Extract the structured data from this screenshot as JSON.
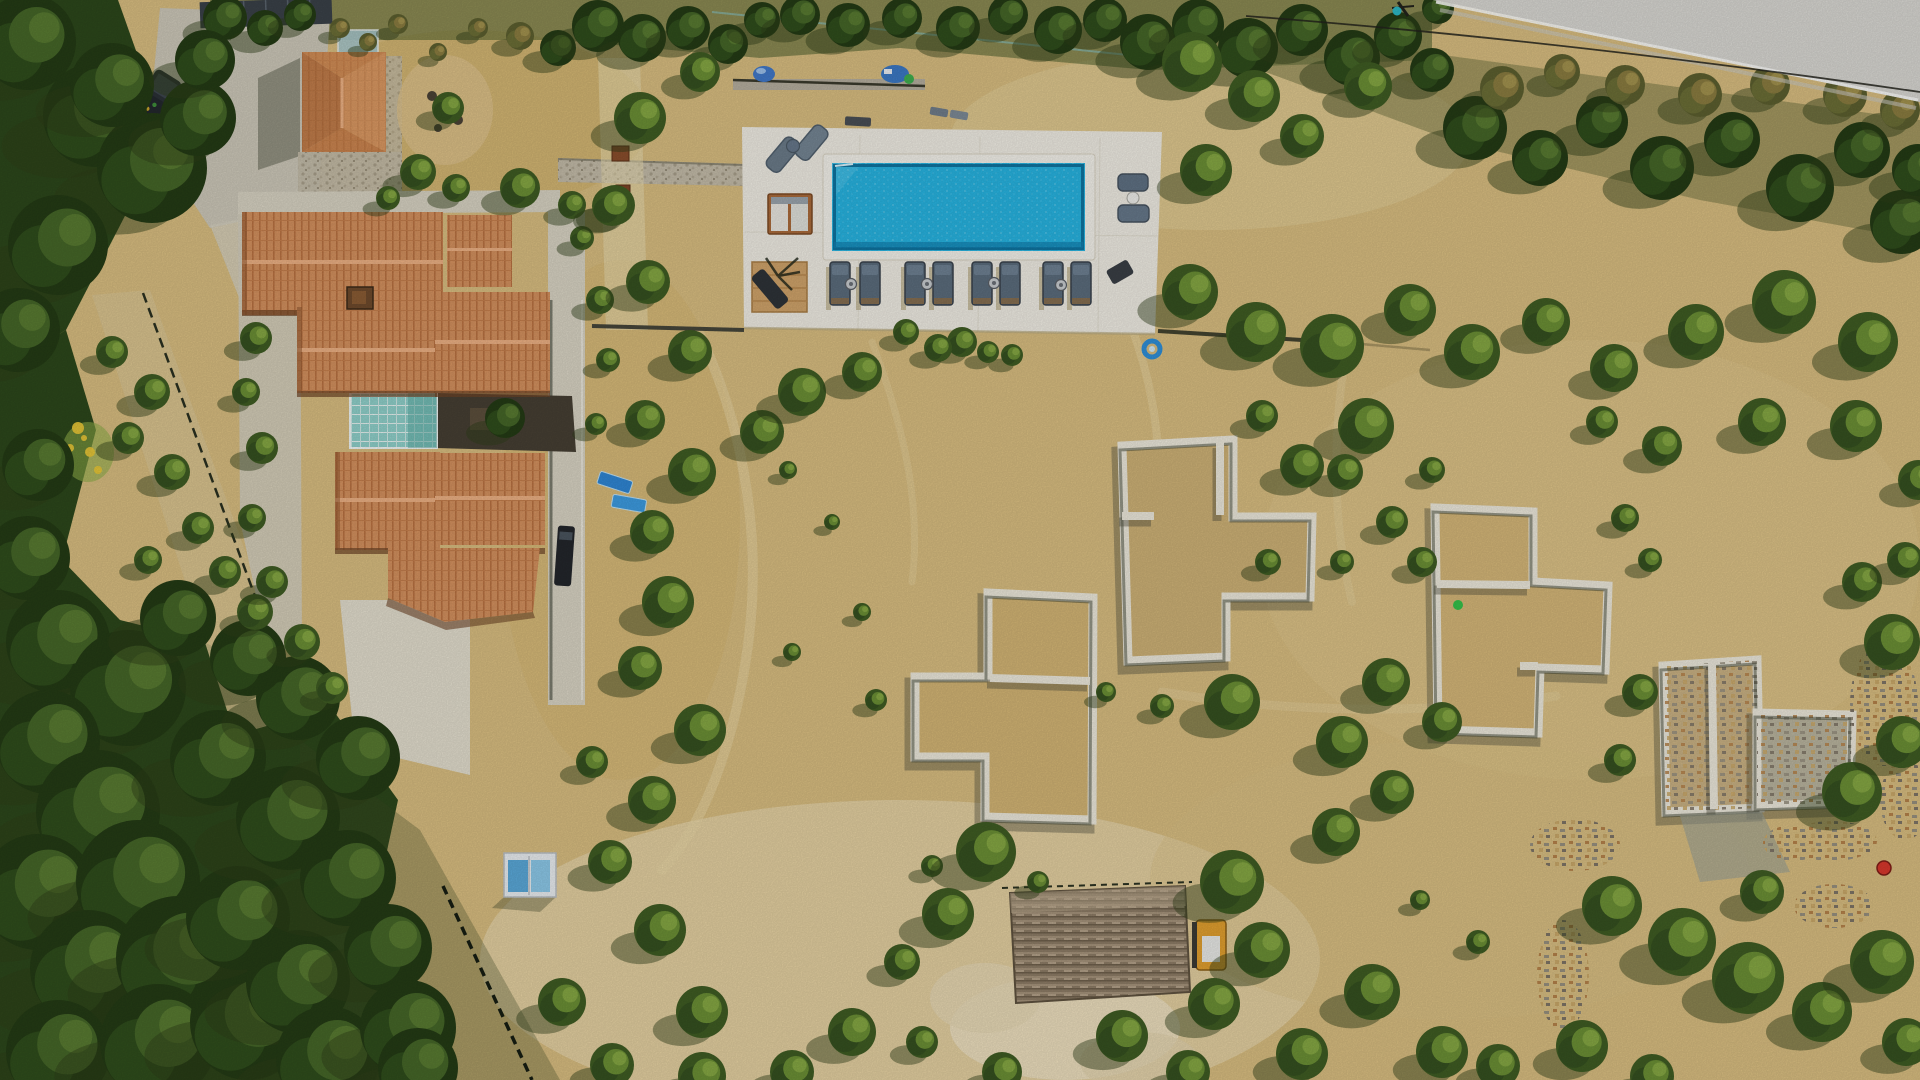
{
  "meta": {
    "type": "aerial-drone-photograph",
    "subject": "Mediterranean villa estate with swimming pool, olive grove and construction foundations",
    "width": 1920,
    "height": 1080,
    "sun_direction": "upper-right",
    "no_visible_text": true
  },
  "palette": {
    "sand": "#d8bd80",
    "sand_light": "#ecdfba",
    "sand_dark": "#c6a55e",
    "forest": "#2c471b",
    "road": "#d8d7d2",
    "driveway": "#ccc7b8",
    "deck": "#efece3",
    "pool_water": "#27b3e0",
    "pool_edge": "#0f74a0",
    "roof_tile": "#d3905e",
    "roof_shadow": "#6e4526",
    "foundation_wall": "#ece8db",
    "lounger": "#5b6c7c",
    "wood_deck": "#8d7c66",
    "atrium_glass": "#8fd0ca"
  },
  "scene": {
    "counts": {
      "sun_loungers_row": 8,
      "side_tables": 4,
      "foundations": 5,
      "cars": 2,
      "villa_roofs": 7
    },
    "pool": {
      "x": 832,
      "y": 163,
      "w": 253,
      "h": 88,
      "lounger_row": {
        "y": 262,
        "w": 20,
        "h": 43,
        "xs": [
          830,
          860,
          905,
          933,
          972,
          1000,
          1043,
          1071
        ],
        "tables": [
          [
            851,
            284
          ],
          [
            927,
            284
          ],
          [
            994,
            283
          ],
          [
            1061,
            285
          ]
        ]
      }
    },
    "foundations": [
      {
        "outline": [
          [
            1122,
            446
          ],
          [
            1233,
            440
          ],
          [
            1233,
            517
          ],
          [
            1312,
            517
          ],
          [
            1310,
            597
          ],
          [
            1226,
            597
          ],
          [
            1226,
            657
          ],
          [
            1128,
            661
          ]
        ],
        "walls": [
          [
            [
              1122,
              516
            ],
            [
              1154,
              516
            ]
          ],
          [
            [
              1220,
              442
            ],
            [
              1220,
              515
            ]
          ]
        ],
        "fill": "#cdb176",
        "rubble": false
      },
      {
        "outline": [
          [
            988,
            593
          ],
          [
            1093,
            598
          ],
          [
            1092,
            820
          ],
          [
            985,
            817
          ],
          [
            985,
            757
          ],
          [
            915,
            757
          ],
          [
            915,
            677
          ],
          [
            988,
            677
          ]
        ],
        "walls": [
          [
            [
              990,
              678
            ],
            [
              1090,
              681
            ]
          ]
        ],
        "fill": "#d2b474",
        "rubble": false
      },
      {
        "outline": [
          [
            1435,
            508
          ],
          [
            1533,
            512
          ],
          [
            1533,
            582
          ],
          [
            1608,
            586
          ],
          [
            1605,
            670
          ],
          [
            1540,
            668
          ],
          [
            1538,
            733
          ],
          [
            1438,
            730
          ]
        ],
        "walls": [
          [
            [
              1437,
              584
            ],
            [
              1530,
              585
            ]
          ],
          [
            [
              1520,
              666
            ],
            [
              1538,
              666
            ]
          ]
        ],
        "fill": "#d4b678",
        "rubble": false
      },
      {
        "outline": [
          [
            1663,
            666
          ],
          [
            1757,
            660
          ],
          [
            1760,
            808
          ],
          [
            1666,
            812
          ]
        ],
        "walls": [
          [
            [
              1712,
              663
            ],
            [
              1714,
              809
            ]
          ]
        ],
        "fill": "#c9b183",
        "rubble": true
      },
      {
        "outline": [
          [
            1757,
            713
          ],
          [
            1852,
            715
          ],
          [
            1850,
            803
          ],
          [
            1757,
            806
          ]
        ],
        "walls": [],
        "fill": "#b9b49e",
        "rubble": true
      }
    ],
    "trees": [
      [
        225,
        18,
        22,
        1
      ],
      [
        265,
        28,
        18,
        1
      ],
      [
        300,
        15,
        16,
        1
      ],
      [
        340,
        28,
        10,
        2
      ],
      [
        368,
        42,
        9,
        2
      ],
      [
        398,
        24,
        10,
        2
      ],
      [
        438,
        52,
        9,
        2
      ],
      [
        478,
        28,
        10,
        2
      ],
      [
        520,
        36,
        14,
        2
      ],
      [
        558,
        48,
        18,
        1
      ],
      [
        598,
        26,
        26,
        1
      ],
      [
        642,
        38,
        24,
        1
      ],
      [
        688,
        28,
        22,
        1
      ],
      [
        728,
        44,
        20,
        1
      ],
      [
        762,
        20,
        18,
        1
      ],
      [
        800,
        15,
        20,
        1
      ],
      [
        848,
        25,
        22,
        1
      ],
      [
        902,
        18,
        20,
        1
      ],
      [
        958,
        28,
        22,
        1
      ],
      [
        1008,
        15,
        20,
        1
      ],
      [
        1058,
        30,
        24,
        1
      ],
      [
        1105,
        20,
        22,
        1
      ],
      [
        1148,
        42,
        28,
        1
      ],
      [
        1198,
        25,
        26,
        1
      ],
      [
        1248,
        48,
        30,
        1
      ],
      [
        1302,
        30,
        26,
        1
      ],
      [
        1352,
        58,
        28,
        1
      ],
      [
        1398,
        36,
        24,
        1
      ],
      [
        1432,
        70,
        22,
        1
      ],
      [
        1438,
        8,
        16,
        1
      ],
      [
        1475,
        128,
        32,
        1
      ],
      [
        1540,
        158,
        28,
        1
      ],
      [
        1602,
        122,
        26,
        1
      ],
      [
        1662,
        168,
        32,
        1
      ],
      [
        1732,
        140,
        28,
        1
      ],
      [
        1800,
        188,
        34,
        1
      ],
      [
        1862,
        150,
        28,
        1
      ],
      [
        1902,
        222,
        32,
        1
      ],
      [
        1502,
        88,
        22,
        2
      ],
      [
        1562,
        72,
        18,
        2
      ],
      [
        1625,
        85,
        20,
        2
      ],
      [
        1700,
        95,
        22,
        2
      ],
      [
        1770,
        85,
        20,
        2
      ],
      [
        1845,
        95,
        22,
        2
      ],
      [
        1900,
        110,
        20,
        2
      ],
      [
        1918,
        170,
        26,
        1
      ],
      [
        28,
        42,
        48,
        1
      ],
      [
        95,
        115,
        52,
        1
      ],
      [
        152,
        168,
        55,
        1
      ],
      [
        58,
        245,
        50,
        1
      ],
      [
        18,
        330,
        42,
        1
      ],
      [
        112,
        85,
        42,
        1
      ],
      [
        198,
        118,
        38,
        1
      ],
      [
        205,
        60,
        30,
        1
      ],
      [
        38,
        465,
        36,
        1
      ],
      [
        28,
        558,
        42,
        1
      ],
      [
        58,
        642,
        52,
        1
      ],
      [
        128,
        688,
        58,
        1
      ],
      [
        48,
        742,
        52,
        1
      ],
      [
        98,
        812,
        62,
        1
      ],
      [
        38,
        892,
        58,
        1
      ],
      [
        138,
        882,
        62,
        1
      ],
      [
        88,
        968,
        58,
        1
      ],
      [
        178,
        958,
        62,
        1
      ],
      [
        58,
        1052,
        52,
        1
      ],
      [
        158,
        1042,
        58,
        1
      ],
      [
        248,
        1022,
        58,
        1
      ],
      [
        238,
        918,
        52,
        1
      ],
      [
        298,
        982,
        52,
        1
      ],
      [
        328,
        1058,
        52,
        1
      ],
      [
        218,
        758,
        48,
        1
      ],
      [
        288,
        818,
        52,
        1
      ],
      [
        348,
        878,
        48,
        1
      ],
      [
        388,
        948,
        44,
        1
      ],
      [
        408,
        1028,
        48,
        1
      ],
      [
        298,
        698,
        42,
        1
      ],
      [
        358,
        758,
        42,
        1
      ],
      [
        248,
        658,
        38,
        1
      ],
      [
        178,
        618,
        38,
        1
      ],
      [
        418,
        1068,
        40,
        1
      ],
      [
        112,
        352,
        16,
        0
      ],
      [
        152,
        392,
        18,
        0
      ],
      [
        128,
        438,
        16,
        0
      ],
      [
        172,
        472,
        18,
        0
      ],
      [
        198,
        528,
        16,
        0
      ],
      [
        148,
        560,
        14,
        0
      ],
      [
        225,
        572,
        16,
        0
      ],
      [
        255,
        612,
        18,
        0
      ],
      [
        256,
        338,
        16,
        0
      ],
      [
        246,
        392,
        14,
        0
      ],
      [
        262,
        448,
        16,
        0
      ],
      [
        252,
        518,
        14,
        0
      ],
      [
        272,
        582,
        16,
        0
      ],
      [
        302,
        642,
        18,
        0
      ],
      [
        332,
        688,
        16,
        0
      ],
      [
        600,
        300,
        14,
        0
      ],
      [
        608,
        360,
        12,
        0
      ],
      [
        596,
        424,
        11,
        0
      ],
      [
        582,
        238,
        12,
        0
      ],
      [
        615,
        205,
        20,
        0
      ],
      [
        572,
        205,
        14,
        0
      ],
      [
        505,
        418,
        20,
        1
      ],
      [
        418,
        172,
        18,
        0
      ],
      [
        456,
        188,
        14,
        0
      ],
      [
        520,
        188,
        20,
        0
      ],
      [
        448,
        108,
        16,
        0
      ],
      [
        388,
        198,
        12,
        0
      ],
      [
        640,
        118,
        26,
        0
      ],
      [
        700,
        72,
        20,
        0
      ],
      [
        612,
        206,
        20,
        0
      ],
      [
        648,
        282,
        22,
        0
      ],
      [
        690,
        352,
        22,
        0
      ],
      [
        645,
        420,
        20,
        0
      ],
      [
        692,
        472,
        24,
        0
      ],
      [
        652,
        532,
        22,
        0
      ],
      [
        668,
        602,
        26,
        0
      ],
      [
        640,
        668,
        22,
        0
      ],
      [
        700,
        730,
        26,
        0
      ],
      [
        652,
        800,
        24,
        0
      ],
      [
        610,
        862,
        22,
        0
      ],
      [
        660,
        930,
        26,
        0
      ],
      [
        702,
        1012,
        26,
        0
      ],
      [
        612,
        1065,
        22,
        0
      ],
      [
        562,
        1002,
        24,
        0
      ],
      [
        592,
        762,
        16,
        0
      ],
      [
        762,
        432,
        22,
        0
      ],
      [
        802,
        392,
        24,
        0
      ],
      [
        862,
        372,
        20,
        0
      ],
      [
        906,
        332,
        13,
        0
      ],
      [
        788,
        470,
        9,
        0
      ],
      [
        832,
        522,
        8,
        0
      ],
      [
        862,
        612,
        9,
        0
      ],
      [
        962,
        342,
        15,
        0
      ],
      [
        1012,
        355,
        11,
        0
      ],
      [
        876,
        700,
        11,
        0
      ],
      [
        792,
        652,
        9,
        0
      ],
      [
        938,
        348,
        14,
        0
      ],
      [
        988,
        352,
        11,
        0
      ],
      [
        932,
        866,
        11,
        0
      ],
      [
        986,
        852,
        30,
        0
      ],
      [
        948,
        914,
        26,
        0
      ],
      [
        1038,
        882,
        11,
        0
      ],
      [
        902,
        962,
        18,
        0
      ],
      [
        852,
        1032,
        24,
        0
      ],
      [
        792,
        1072,
        22,
        0
      ],
      [
        702,
        1076,
        24,
        0
      ],
      [
        922,
        1042,
        16,
        0
      ],
      [
        1002,
        1072,
        20,
        0
      ],
      [
        1122,
        1036,
        26,
        0
      ],
      [
        1188,
        1072,
        22,
        0
      ],
      [
        1232,
        882,
        32,
        0
      ],
      [
        1262,
        950,
        28,
        0
      ],
      [
        1214,
        1004,
        26,
        0
      ],
      [
        1302,
        1054,
        26,
        0
      ],
      [
        1372,
        992,
        28,
        0
      ],
      [
        1442,
        1052,
        26,
        0
      ],
      [
        1498,
        1066,
        22,
        0
      ],
      [
        1582,
        1046,
        26,
        0
      ],
      [
        1652,
        1076,
        22,
        0
      ],
      [
        1612,
        906,
        30,
        0
      ],
      [
        1682,
        942,
        34,
        0
      ],
      [
        1748,
        978,
        36,
        0
      ],
      [
        1822,
        1012,
        30,
        0
      ],
      [
        1882,
        962,
        32,
        0
      ],
      [
        1906,
        1042,
        24,
        0
      ],
      [
        1762,
        892,
        22,
        0
      ],
      [
        1852,
        792,
        30,
        0
      ],
      [
        1902,
        742,
        26,
        0
      ],
      [
        1892,
        642,
        28,
        0
      ],
      [
        1862,
        582,
        20,
        0
      ],
      [
        1478,
        942,
        12,
        0
      ],
      [
        1420,
        900,
        10,
        0
      ],
      [
        1192,
        62,
        30,
        0
      ],
      [
        1254,
        96,
        26,
        0
      ],
      [
        1206,
        170,
        26,
        0
      ],
      [
        1302,
        136,
        22,
        0
      ],
      [
        1368,
        86,
        24,
        0
      ],
      [
        1190,
        292,
        28,
        0
      ],
      [
        1256,
        332,
        30,
        0
      ],
      [
        1332,
        346,
        32,
        0
      ],
      [
        1410,
        310,
        26,
        0
      ],
      [
        1472,
        352,
        28,
        0
      ],
      [
        1546,
        322,
        24,
        0
      ],
      [
        1614,
        368,
        24,
        0
      ],
      [
        1696,
        332,
        28,
        0
      ],
      [
        1784,
        302,
        32,
        0
      ],
      [
        1868,
        342,
        30,
        0
      ],
      [
        1856,
        426,
        26,
        0
      ],
      [
        1762,
        422,
        24,
        0
      ],
      [
        1662,
        446,
        20,
        0
      ],
      [
        1602,
        422,
        16,
        0
      ],
      [
        1366,
        426,
        28,
        0
      ],
      [
        1302,
        466,
        22,
        0
      ],
      [
        1262,
        416,
        16,
        0
      ],
      [
        1432,
        470,
        13,
        0
      ],
      [
        1342,
        562,
        12,
        0
      ],
      [
        1422,
        562,
        15,
        0
      ],
      [
        1268,
        562,
        13,
        0
      ],
      [
        1106,
        692,
        10,
        0
      ],
      [
        1162,
        706,
        12,
        0
      ],
      [
        1232,
        702,
        28,
        0
      ],
      [
        1386,
        682,
        24,
        0
      ],
      [
        1442,
        722,
        20,
        0
      ],
      [
        1342,
        742,
        26,
        0
      ],
      [
        1392,
        792,
        22,
        0
      ],
      [
        1336,
        832,
        24,
        0
      ],
      [
        1345,
        472,
        18,
        0
      ],
      [
        1392,
        522,
        16,
        0
      ],
      [
        1625,
        518,
        14,
        0
      ],
      [
        1650,
        560,
        12,
        0
      ],
      [
        1640,
        692,
        18,
        0
      ],
      [
        1620,
        760,
        16,
        0
      ],
      [
        1905,
        560,
        18,
        0
      ],
      [
        1918,
        480,
        20,
        0
      ]
    ]
  }
}
